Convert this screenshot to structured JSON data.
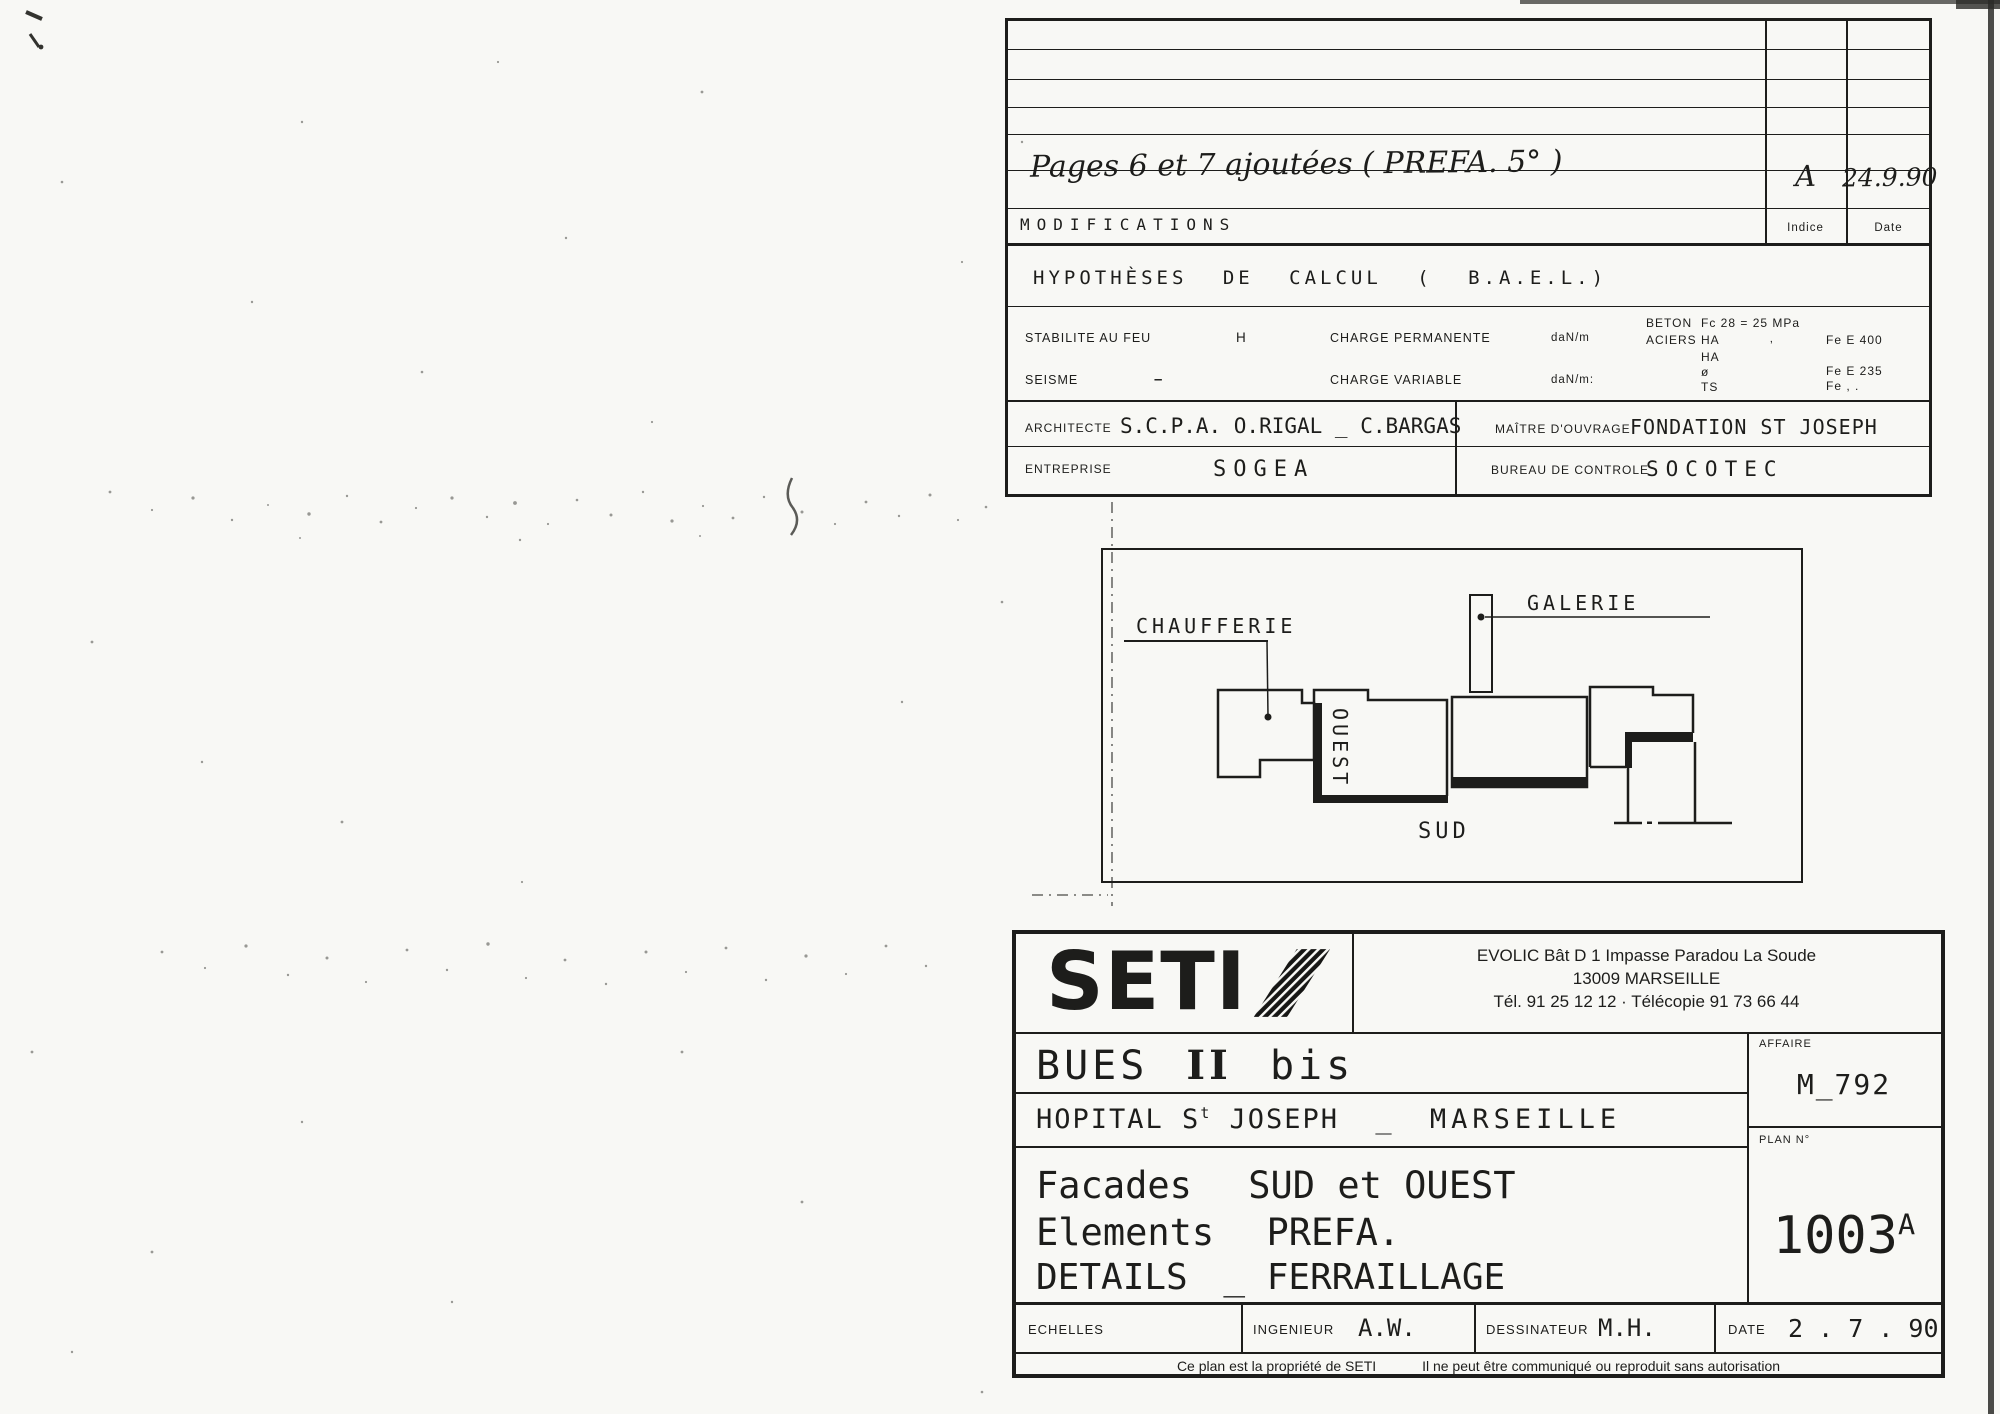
{
  "colors": {
    "ink": "#1d1d1b",
    "paper": "#f8f8f5"
  },
  "modifications": {
    "entry": "Pages 6 et 7 ajoutées ( PREFA. 5° )",
    "indice_value": "A",
    "date_value": "24.9.90",
    "label": "MODIFICATIONS",
    "indice_label": "Indice",
    "date_label": "Date"
  },
  "hypotheses": {
    "title": "HYPOTHÈSES DE CALCUL ( B.A.E.L.)",
    "stabilite_label": "STABILITE AU FEU",
    "stabilite_value": "H",
    "seisme_label": "SEISME",
    "seisme_value": "–",
    "charge_perm_label": "CHARGE PERMANENTE",
    "charge_perm_unit": "daN/m",
    "charge_var_label": "CHARGE VARIABLE",
    "charge_var_unit": "daN/m:",
    "beton_label": "BETON",
    "beton_value": "Fc 28 = 25 MPa",
    "aciers_label": "ACIERS",
    "aciers": [
      {
        "n": "HA",
        "mid": "‚",
        "fe": "Fe E 400"
      },
      {
        "n": "HA",
        "mid": "",
        "fe": ""
      },
      {
        "n": "ø",
        "mid": "",
        "fe": "Fe E 235"
      },
      {
        "n": "TS",
        "mid": "",
        "fe": "Fe , ."
      }
    ]
  },
  "parties": {
    "architecte_label": "ARCHITECTE",
    "architecte": "S.C.P.A.  O.RIGAL _ C.BARGAS",
    "maitre_label": "MAÎTRE D'OUVRAGE",
    "maitre": "FONDATION ST JOSEPH",
    "entreprise_label": "ENTREPRISE",
    "entreprise": "SOGEA",
    "bureau_label": "BUREAU DE CONTROLE",
    "bureau": "SOCOTEC"
  },
  "plan_figure": {
    "chaufferie": "CHAUFFERIE",
    "galerie": "GALERIE",
    "ouest": "OUEST",
    "sud": "SUD"
  },
  "company": {
    "logo_text": "SETI",
    "address_line1": "EVOLIC   Bât D 1   Impasse Paradou   La Soude",
    "address_line2": "13009 MARSEILLE",
    "address_line3": "Tél. 91 25 12 12    ·    Télécopie 91 73 66 44"
  },
  "project": {
    "name_part1": "BUES",
    "name_part2": "II",
    "name_part3": "bis",
    "location_prefix": "HOPITAL S",
    "location_sup": "t",
    "location_mid": "JOSEPH",
    "location_dash": "_",
    "location_city": "MARSEILLE",
    "title1a": "Facades",
    "title1b": "SUD et OUEST",
    "title2a": "Elements",
    "title2b": "PREFA.",
    "title3a": "DETAILS",
    "title3b": "_ FERRAILLAGE",
    "affaire_label": "AFFAIRE",
    "affaire_value": "M_792",
    "plan_label": "PLAN N°",
    "plan_number": "1003",
    "plan_index": "A"
  },
  "footer": {
    "echelles_label": "ECHELLES",
    "ingenieur_label": "INGENIEUR",
    "ingenieur_value": "A.W.",
    "dessinateur_label": "DESSINATEUR",
    "dessinateur_value": "M.H.",
    "date_label": "DATE",
    "date_value": "2 . 7 . 90",
    "copyright_1": "Ce plan est la propriété de SETI",
    "copyright_2": "Il ne peut être communiqué ou reproduit sans autorisation"
  }
}
